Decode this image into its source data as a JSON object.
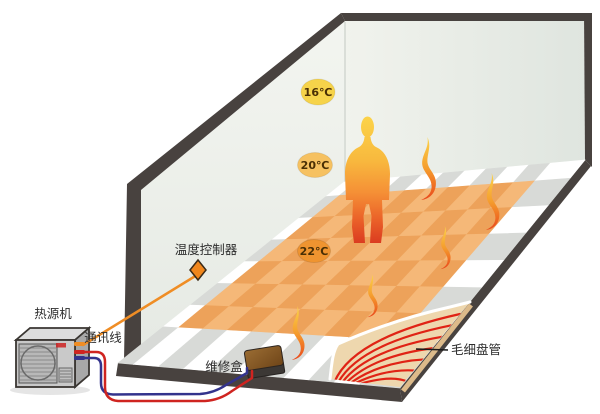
{
  "diagram": {
    "badges": [
      {
        "id": "temp-16",
        "label": "16℃"
      },
      {
        "id": "temp-20",
        "label": "20℃"
      },
      {
        "id": "temp-22",
        "label": "22℃"
      }
    ],
    "labels": {
      "thermostat_controller": "温度控制器",
      "heat_source_unit": "热源机",
      "communication_line": "通讯线",
      "service_box": "维修盒",
      "capillary_coil": "毛细盘管"
    },
    "colors": {
      "frame_dark": "#48423f",
      "wall_light": "#f0f2ec",
      "wall_shade": "#e0e6e0",
      "tile_light": "#f5b878",
      "tile_dark": "#eda25a",
      "border_check_white": "#ffffff",
      "border_check_gray": "#d8dad7",
      "screed_tan": "#eed7ae",
      "screed_edge_tan": "#dcba8a",
      "coil_red": "#e02315",
      "pipe_red": "#cf2420",
      "pipe_blue": "#33338c",
      "comm_orange": "#ef8d25",
      "badge_16": "#f6d34a",
      "badge_20": "#f6c161",
      "badge_22": "#ef9430",
      "flame_top": "#fcd44b",
      "flame_bottom": "#e8481d",
      "person_top": "#fcd449",
      "person_bottom": "#da3a20",
      "unit_front": "#c9c9c9",
      "unit_top": "#dddddd",
      "unit_side": "#a8a8a8",
      "box_brown": "#8e6029"
    }
  }
}
